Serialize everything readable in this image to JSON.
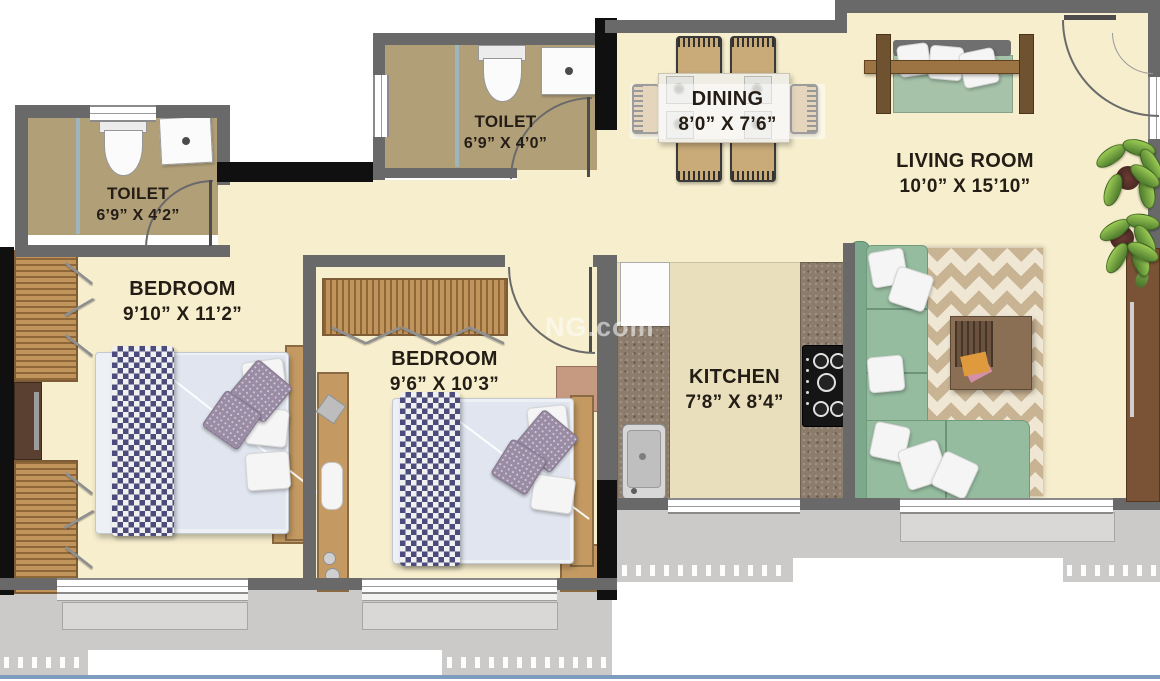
{
  "plan": {
    "watermark": "NG.com",
    "rooms": {
      "toilet1": {
        "name": "TOILET",
        "dims": "6’9” X 4’2”"
      },
      "toilet2": {
        "name": "TOILET",
        "dims": "6’9” X 4’0”"
      },
      "dining": {
        "name": "DINING",
        "dims": "8’0” X 7’6”"
      },
      "living": {
        "name": "LIVING ROOM",
        "dims": "10’0” X 15’10”"
      },
      "bedroom1": {
        "name": "BEDROOM",
        "dims": "9’10” X 11’2”"
      },
      "bedroom2": {
        "name": "BEDROOM",
        "dims": "9’6” X 10’3”"
      },
      "kitchen": {
        "name": "KITCHEN",
        "dims": "7’8” X 8’4”"
      }
    },
    "colors": {
      "floor": "#f7eecd",
      "toilet_floor": "#b19f78",
      "kitchen_floor": "#e9dfbd",
      "wall": "#696969",
      "wall_dark": "#101010",
      "balcony": "#cbcac8",
      "sofa_green": "#95bc9f",
      "rug_beige": "#c8b493",
      "wood": "#c49a62",
      "footer_line": "#7e9cbe"
    }
  }
}
